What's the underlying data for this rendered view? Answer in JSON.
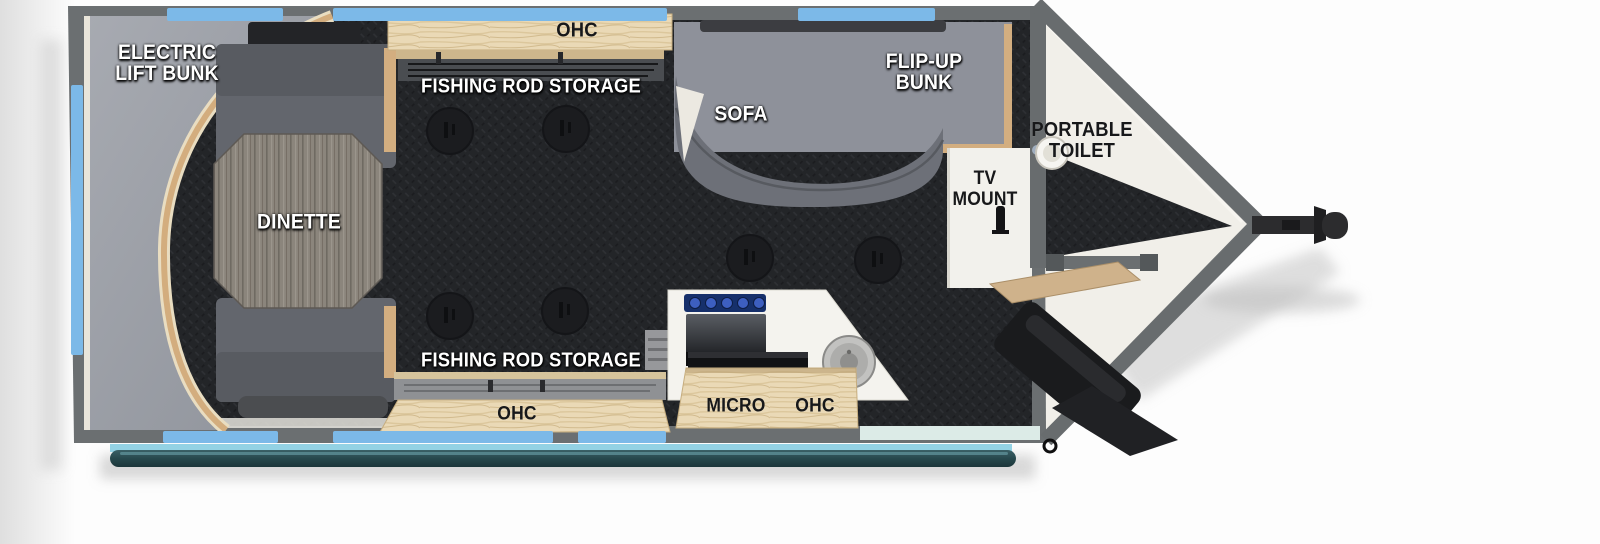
{
  "floorplan": {
    "type": "travel-trailer-fish-house-floorplan",
    "labels": {
      "electric_lift_bunk": {
        "line1": "ELECTRIC",
        "line2": "LIFT BUNK"
      },
      "ohc_top": "OHC",
      "fishing_rod_storage_top": "FISHING ROD STORAGE",
      "sofa": "SOFA",
      "flip_up_bunk": {
        "line1": "FLIP-UP",
        "line2": "BUNK"
      },
      "portable_toilet": {
        "line1": "PORTABLE",
        "line2": "TOILET"
      },
      "tv_mount": {
        "line1": "TV",
        "line2": "MOUNT"
      },
      "dinette": "DINETTE",
      "fishing_rod_storage_bottom": "FISHING ROD STORAGE",
      "ohc_bottom": "OHC",
      "micro": "MICRO",
      "ohc_kitchen": "OHC"
    },
    "features": {
      "fishing_hole_count": 6,
      "window_strips": "light blue",
      "front": "v-nose with tongue hitch at right"
    },
    "colors": {
      "floor_diamond_plate": "#232528",
      "wall_gray": "#6b6f71",
      "window_blue": "#7cb9e8",
      "cabinet_wood": "#ead9b6",
      "bunk_gray": "#a0a4ab",
      "bench_gray": "#63666d",
      "table_wood_gray": "#8b857c",
      "vnose_floor_white": "#f1efe9",
      "awning_teal": "#2b4d52",
      "cooktop_burner_blue": "#16306b",
      "hitch_black": "#2c2c2e"
    }
  }
}
